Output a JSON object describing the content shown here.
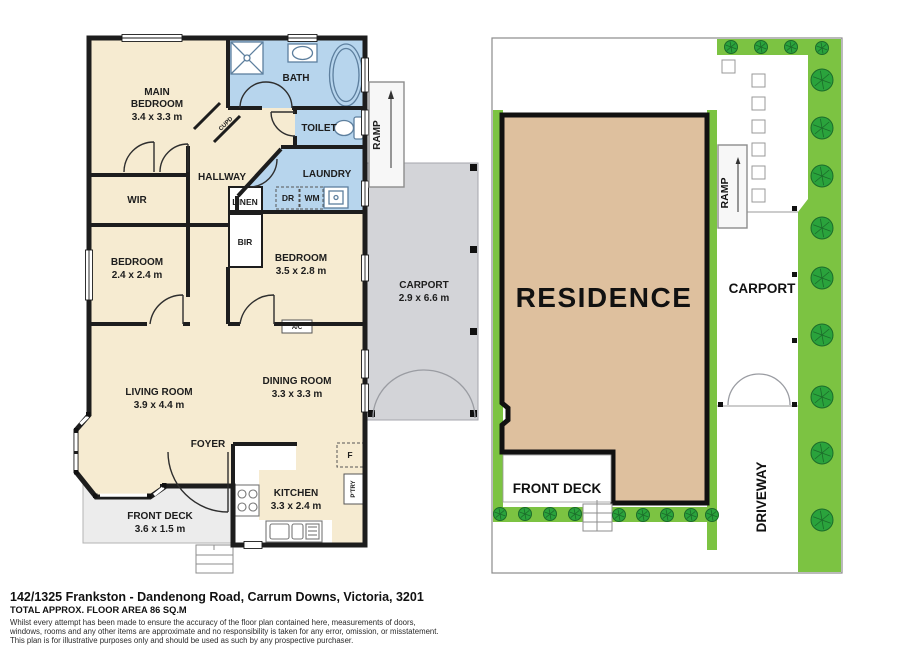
{
  "fp": {
    "main_bedroom": {
      "line1": "MAIN",
      "line2": "BEDROOM",
      "dims": "3.4 x 3.3 m"
    },
    "wir": "WIR",
    "bath": "BATH",
    "toilet": "TOILET",
    "laundry": "LAUNDRY",
    "hallway": "HALLWAY",
    "linen": "LINEN",
    "cupd": "CUPD",
    "bir": "BIR",
    "dr": "DR",
    "wm": "WM",
    "bedroom2": {
      "name": "BEDROOM",
      "dims": "2.4 x 2.4 m"
    },
    "bedroom3": {
      "name": "BEDROOM",
      "dims": "3.5 x 2.8 m"
    },
    "ac": "A/C",
    "living": {
      "name": "LIVING ROOM",
      "dims": "3.9 x 4.4 m"
    },
    "dining": {
      "name": "DINING ROOM",
      "dims": "3.3 x 3.3 m"
    },
    "foyer": "FOYER",
    "fridge": "F",
    "kitchen": {
      "name": "KITCHEN",
      "dims": "3.3 x 2.4 m"
    },
    "pantry": "P'TRY",
    "front_deck": {
      "name": "FRONT DECK",
      "dims": "3.6 x 1.5 m"
    },
    "carport": {
      "name": "CARPORT",
      "dims": "2.9 x 6.6 m"
    },
    "ramp": "RAMP"
  },
  "site": {
    "residence": "RESIDENCE",
    "carport": "CARPORT",
    "driveway": "DRIVEWAY",
    "front_deck": "FRONT DECK",
    "ramp": "RAMP"
  },
  "footer": {
    "address": "142/1325 Frankston - Dandenong Road, Carrum Downs, Victoria, 3201",
    "floor_area": "TOTAL APPROX. FLOOR AREA 86 SQ.M",
    "disclaimer1": "Whilst every attempt has been made to ensure the accuracy of the floor plan contained here, measurements of doors,",
    "disclaimer2": "windows, rooms and any other items are approximate and no responsibility is taken for any error, omission, or misstatement.",
    "disclaimer3": "This plan is for illustrative purposes only and should be used as such by any prospective purchaser."
  },
  "colors": {
    "wall": "#1d1d1d",
    "floor_cream": "#f6ebd1",
    "wet_blue": "#b7d5ed",
    "carport_gray": "#d3d4d8",
    "deck_gray": "#ececec",
    "fixture_blue": "#5d7f9e",
    "site_green": "#7cc342",
    "tree_green": "#2aa33c",
    "tree_line": "#1c6b2a",
    "residence_tan": "#dec09e",
    "text_dark": "#1d1d1d",
    "boundary_gray": "#8b8b8b"
  }
}
